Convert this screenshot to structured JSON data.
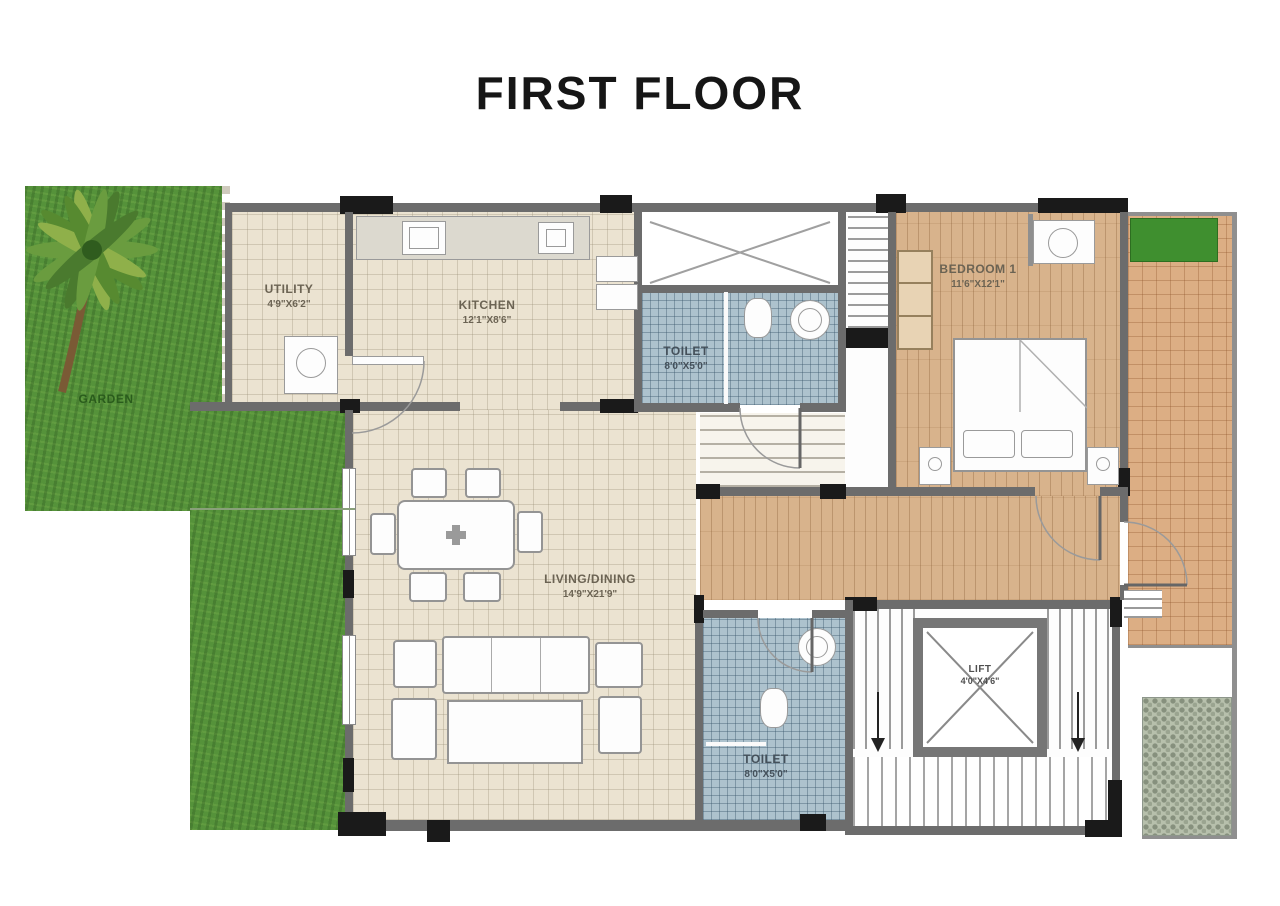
{
  "title": "FIRST FLOOR",
  "rooms": {
    "garden": {
      "name": "GARDEN"
    },
    "utility": {
      "name": "UTILITY",
      "dims": "4'9\"X6'2\""
    },
    "kitchen": {
      "name": "KITCHEN",
      "dims": "12'1\"X8'6\""
    },
    "toilet1": {
      "name": "TOILET",
      "dims": "8'0\"X5'0\""
    },
    "bedroom1": {
      "name": "BEDROOM 1",
      "dims": "11'6\"X12'1\""
    },
    "living": {
      "name": "LIVING/DINING",
      "dims": "14'9\"X21'9\""
    },
    "toilet2": {
      "name": "TOILET",
      "dims": "8'0\"X5'0\""
    },
    "lift": {
      "name": "LIFT",
      "dims": "4'0\"X4'6\""
    }
  },
  "colors": {
    "wall": "#6c6c6c",
    "wall_dark": "#1a1a1a",
    "garden_green": "#55923a",
    "floor_tile": "#ebe3d1",
    "floor_wood": "#d8b38c",
    "terracotta": "#dcae84",
    "toilet_tile": "#adc2cd",
    "pebble": "#b7c0ac",
    "title_text": "#161616"
  }
}
